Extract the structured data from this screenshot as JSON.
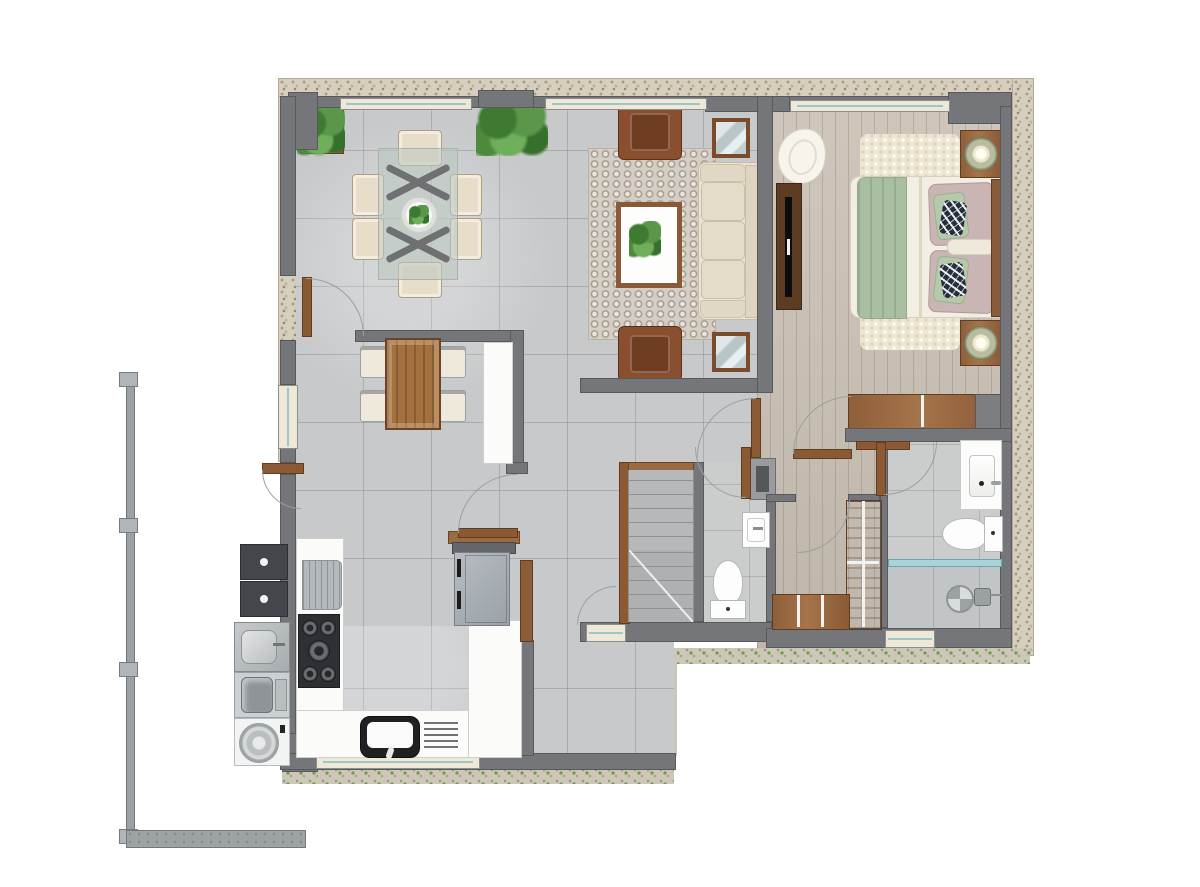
{
  "document": {
    "type": "architectural floor plan",
    "view": "top-down furnished ground-floor rendering",
    "labels_visible": false,
    "text_content": "none"
  },
  "palette": {
    "background": "#ffffff",
    "exterior_pebble": "#d6cfbe",
    "gravel_grass": "#ccc7b6",
    "wall_gray": "#75767a",
    "tile_floor": "#c7c9ca",
    "wood_floor": "#c9c0b4",
    "window_glass": "#9cc7ca",
    "window_sill": "#efe8d6",
    "furniture_wood": "#996841",
    "upholstery_cream": "#e7ddc8",
    "accent_sage": "#a9bfa1",
    "accent_mauve": "#c9b5b4",
    "armchair_brown": "#8a4f2e",
    "plant_green": "#4e8a3e",
    "appliance_dark": "#2e3033",
    "shower_glass": "#a7d4d8"
  },
  "rooms": [
    {
      "id": "dining",
      "name": "dining area",
      "floor": "gray ceramic tile",
      "items": [
        "glass dining table with x-legs",
        "six cream chairs",
        "round center plate with plant",
        "two potted plants"
      ]
    },
    {
      "id": "living",
      "name": "living room",
      "floor": "gray tile with patterned rug",
      "items": [
        "three-seat cream sofa",
        "wood coffee table with plant",
        "two brown armchairs",
        "two wood-framed mirrors"
      ]
    },
    {
      "id": "bedroom",
      "name": "bedroom",
      "floor": "light wood plank",
      "items": [
        "double bed with sage runner and cushions",
        "two nightstands with round lamps",
        "tv console with tv",
        "white lounge chair",
        "cream shag rug",
        "dresser"
      ]
    },
    {
      "id": "bathroom",
      "name": "ensuite bathroom",
      "floor": "gray tile",
      "items": [
        "vanity sink",
        "toilet",
        "walk-in shower with glass screen",
        "floor drain",
        "towel shelf"
      ]
    },
    {
      "id": "closet",
      "name": "walk-in closet",
      "floor": "light wood plank",
      "items": [
        "l-shaped wardrobe"
      ]
    },
    {
      "id": "powder",
      "name": "powder room",
      "floor": "gray tile",
      "items": [
        "wall-hung sink",
        "toilet"
      ]
    },
    {
      "id": "stairs",
      "name": "staircase",
      "items": [
        "wood handrail",
        "concrete treads"
      ]
    },
    {
      "id": "kitchen",
      "name": "kitchen",
      "floor": "gray tile",
      "items": [
        "u-shaped white counter",
        "five-burner gas cooktop",
        "sink with drainboard",
        "refrigerator with shelf",
        "gray base cabinet",
        "breakfast table with four chairs",
        "pass-through counter"
      ]
    },
    {
      "id": "service",
      "name": "outdoor service and laundry strip",
      "items": [
        "two dark service units",
        "steel laundry sink",
        "washing machine",
        "dryer"
      ]
    },
    {
      "id": "exterior",
      "name": "site boundary",
      "items": [
        "metal fence with posts",
        "concrete strip",
        "pebble wall border",
        "gravel and grass edge",
        "patio tile"
      ]
    }
  ]
}
